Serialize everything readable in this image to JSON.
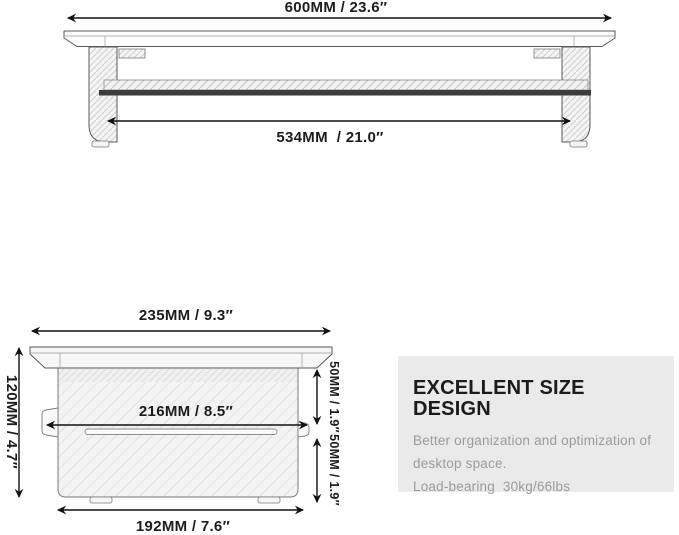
{
  "front_view": {
    "dim_total_width": "600MM / 23.6″",
    "dim_inner_width": "534MM  / 21.0″"
  },
  "side_view": {
    "dim_top_width": "235MM / 9.3″",
    "dim_height": "120MM / 4.7″",
    "dim_mid_width": "216MM / 8.5″",
    "dim_upper_gap": "50MM / 1.9″",
    "dim_lower_gap": "50MM / 1.9″",
    "dim_bottom_width": "192MM / 7.6″"
  },
  "info_box": {
    "title": "EXCELLENT SIZE DESIGN",
    "body_line1": "Better organization and optimization of",
    "body_line2": "desktop space.",
    "body_line3": "Load-bearing  30kg/66lbs"
  },
  "colors": {
    "background": "#ffffff",
    "line_art": "#5a5a5a",
    "dimension_text": "#1c1c1c",
    "dark_crossbar": "#3d3d3d",
    "info_box_background": "#eaeaea",
    "info_title_text": "#1b1b1b",
    "info_body_text": "#9b9b9b"
  }
}
